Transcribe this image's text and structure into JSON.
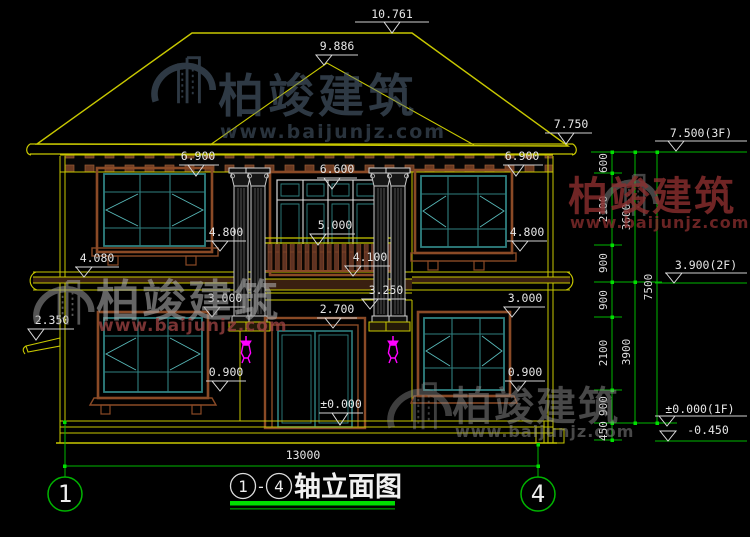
{
  "watermark": {
    "brand": "柏竣建筑",
    "url": "www.baijunjz.com"
  },
  "labels": {
    "ridge": "10.761",
    "hip": "9.886",
    "eave_top": "7.750",
    "eave_left": "6.900",
    "eave_right": "6.900",
    "door2_top": "6.600",
    "railing_top": "5.000",
    "sill2_left": "4.800",
    "sill2_right": "4.800",
    "balcony_floor": "4.100",
    "band_left": "4.080",
    "band_center": "3.250",
    "win1_left": "3.000",
    "win1_right": "3.000",
    "door1_top": "2.700",
    "canopy": "2.350",
    "sill1_left": "0.900",
    "sill1_right": "0.900",
    "ground_zero": "±0.000"
  },
  "right_dims": {
    "segments": [
      "600",
      "2100",
      "900",
      "900",
      "2100",
      "900",
      "450"
    ],
    "floor_spans": [
      "3600",
      "3900"
    ],
    "total": "7500",
    "levels": [
      {
        "label": "7.500(3F)"
      },
      {
        "label": "3.900(2F)"
      },
      {
        "label": "±0.000(1F)"
      },
      {
        "label": "-0.450"
      }
    ]
  },
  "bottom": {
    "overall_width": "13000",
    "axis_left": "1",
    "axis_right": "4",
    "title": {
      "from": "1",
      "dash": "-",
      "to": "4",
      "text": "轴立面图"
    }
  }
}
